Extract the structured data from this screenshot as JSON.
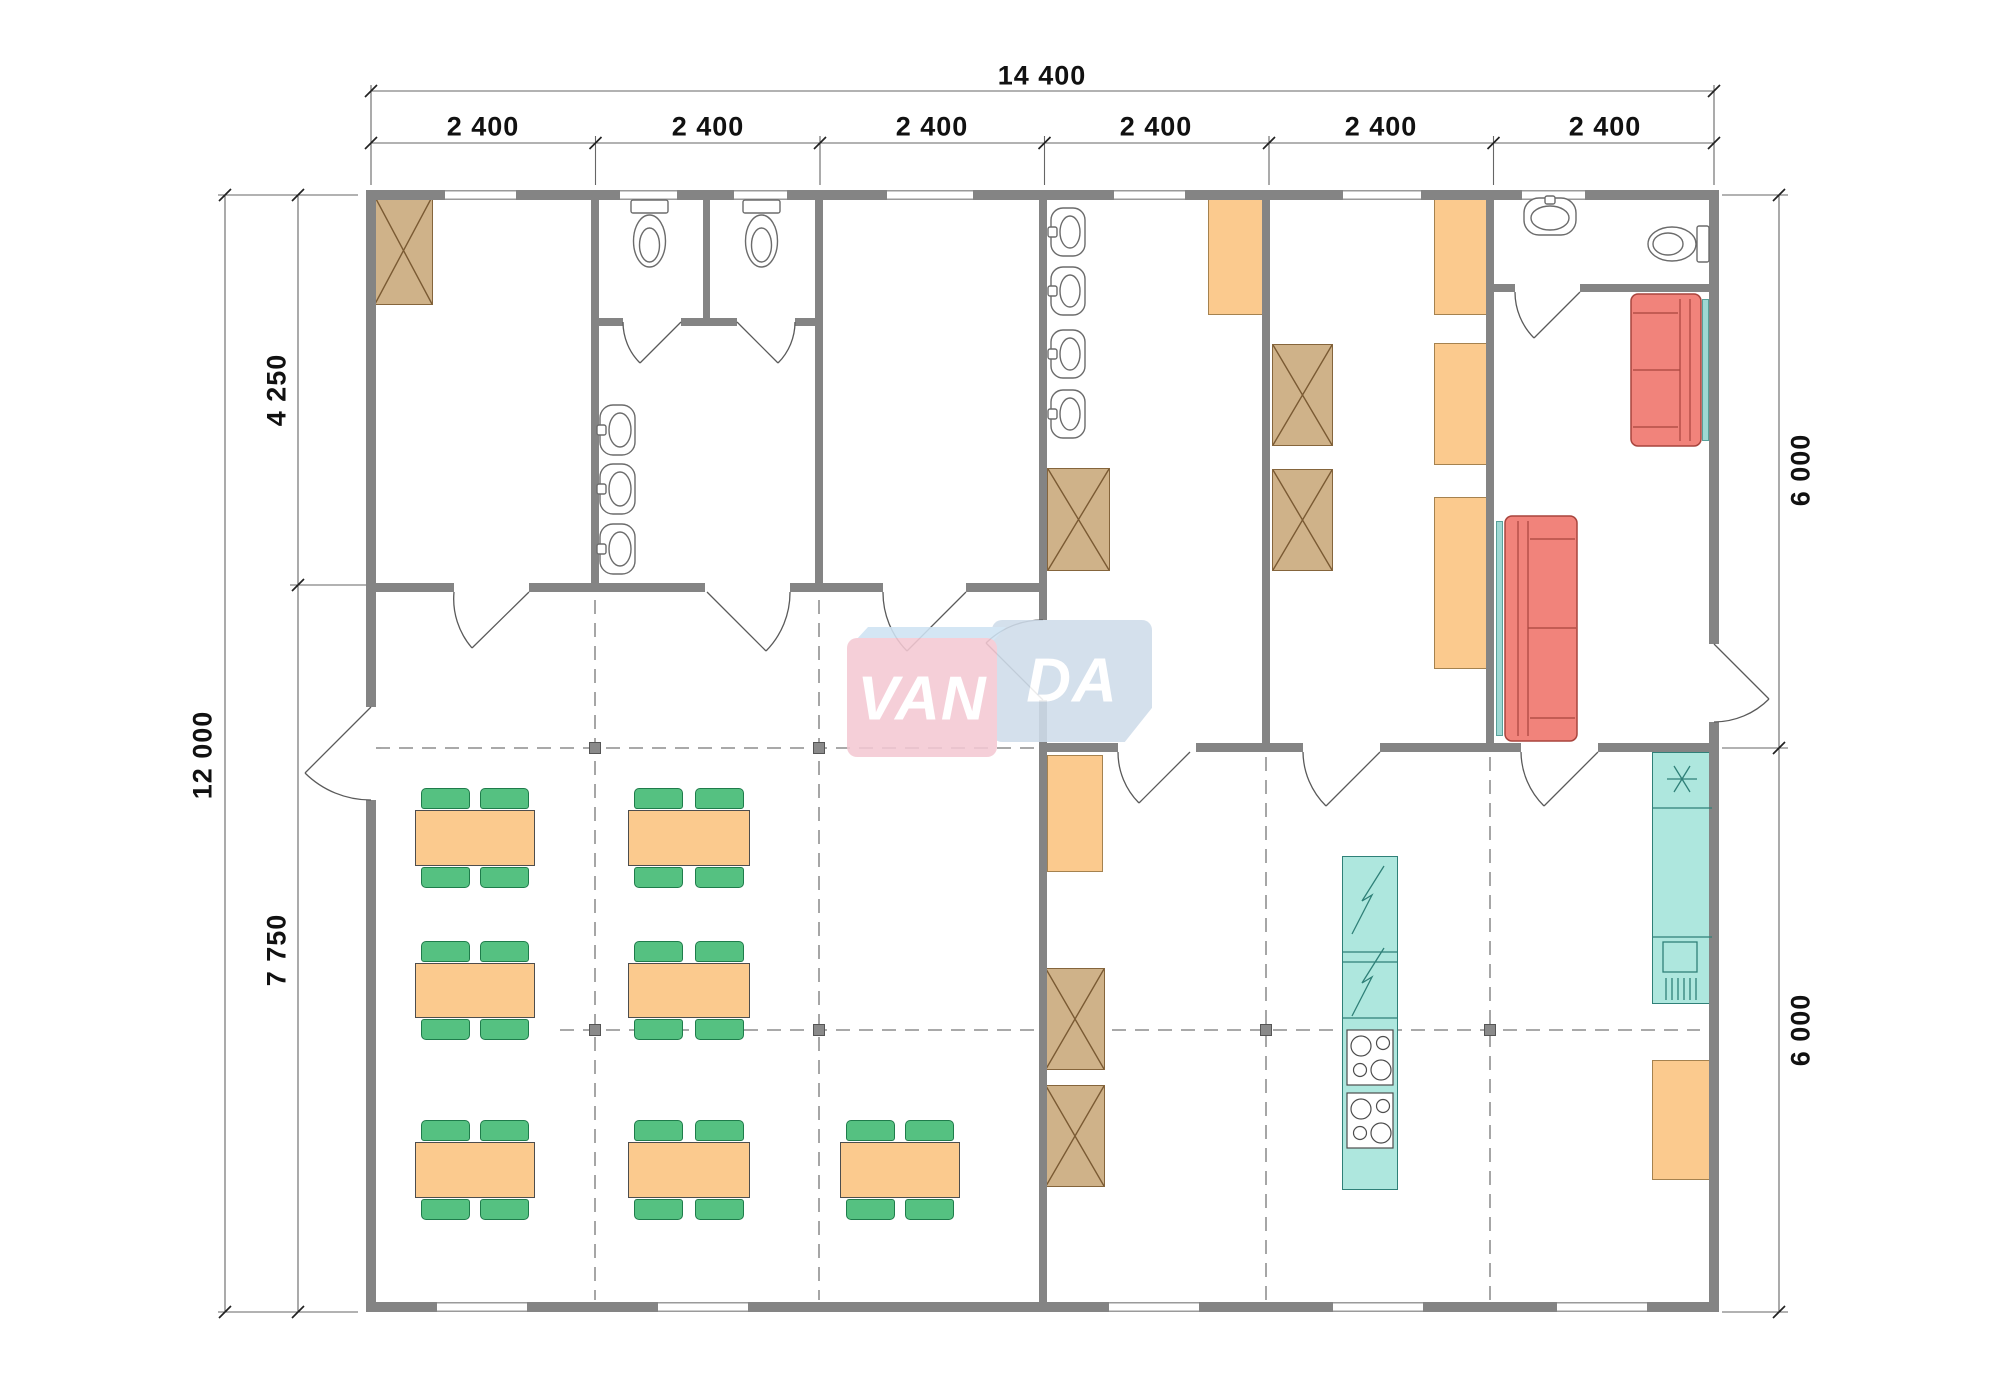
{
  "watermark": {
    "text": "VANDA",
    "part1": "VAN",
    "part2": "DA"
  },
  "dimensions": {
    "top_total": "14 400",
    "top_modules": [
      "2 400",
      "2 400",
      "2 400",
      "2 400",
      "2 400",
      "2 400"
    ],
    "left_total": "12 000",
    "left_upper": "4 250",
    "left_lower": "7 750",
    "right_upper": "6 000",
    "right_lower": "6 000"
  },
  "colors": {
    "wall": "#848484",
    "tan": "#cfb289",
    "tanStroke": "#85653c",
    "orange": "#fbca8e",
    "orangeStroke": "#a5824f",
    "green": "#55c181",
    "greenStroke": "#1f7c4b",
    "teal": "#aee7de",
    "tealStroke": "#2f8078",
    "red": "#f1837b",
    "redStroke": "#a8443d",
    "wmPink": "#f4c9d3",
    "wmBlue": "#cfdcea"
  }
}
